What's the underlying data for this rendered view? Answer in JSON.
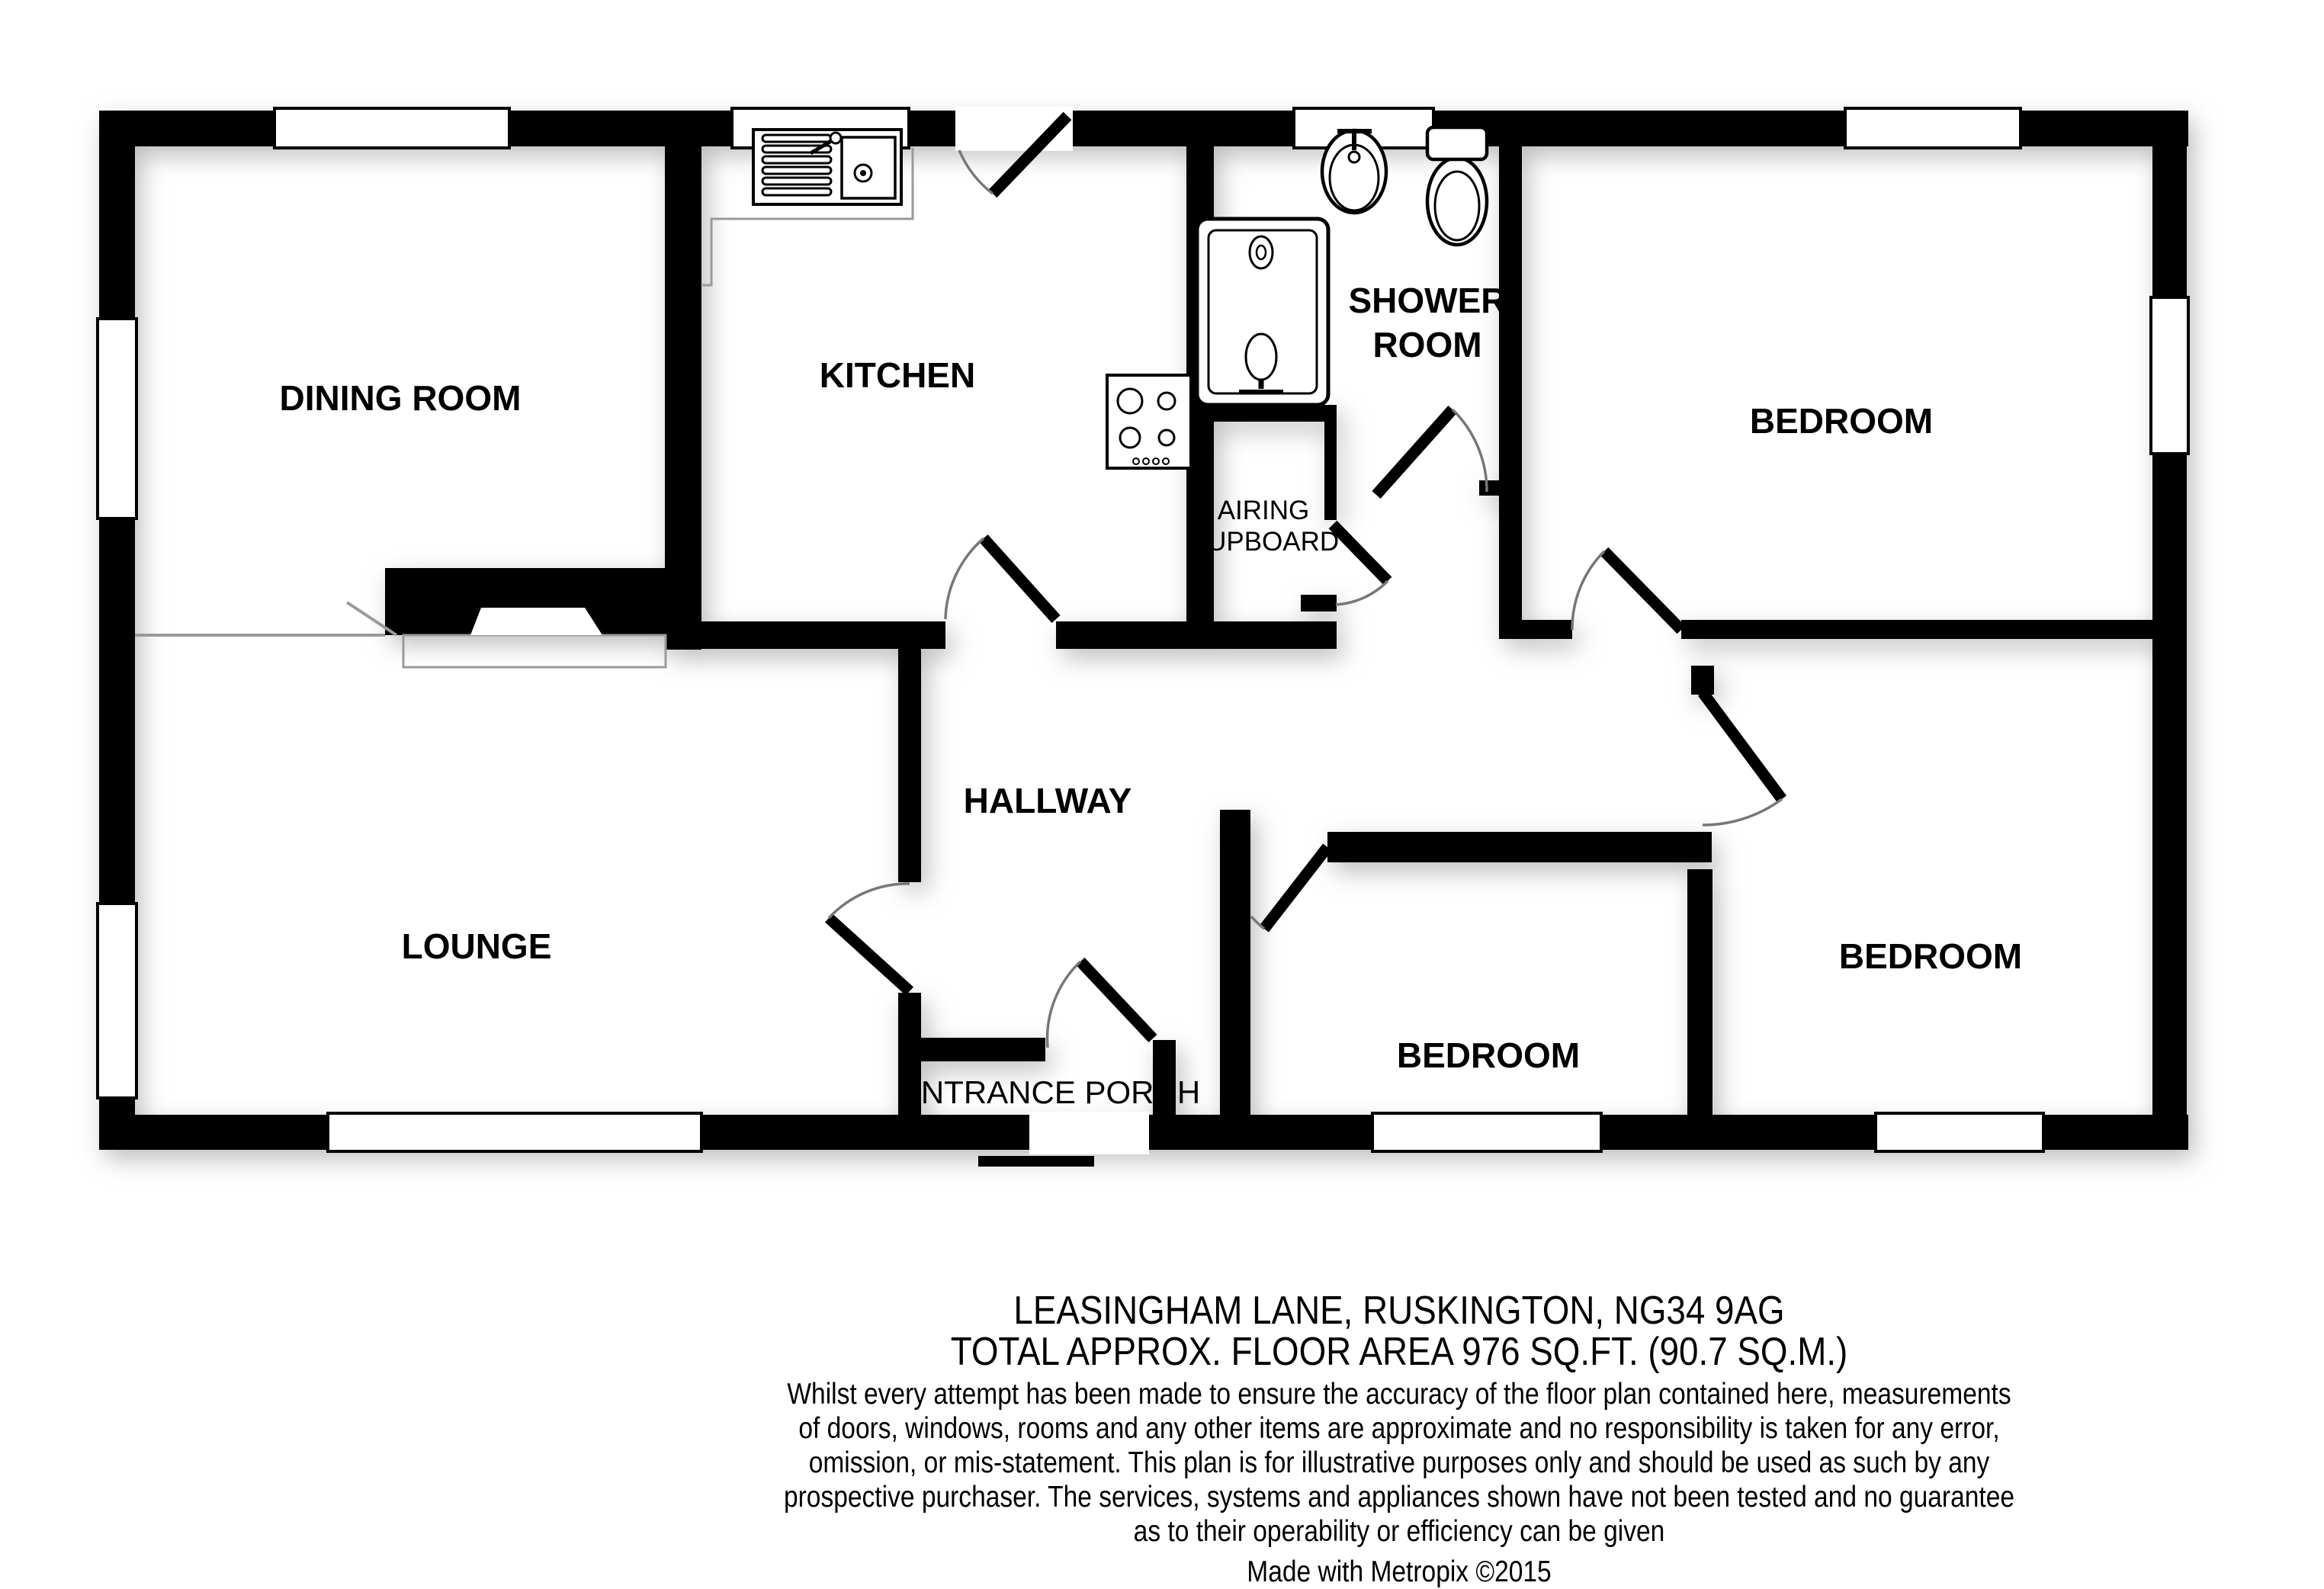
{
  "plan": {
    "rooms": {
      "dining_room": {
        "label": "DINING ROOM"
      },
      "kitchen": {
        "label": "KITCHEN"
      },
      "shower_room": {
        "label_line1": "SHOWER",
        "label_line2": "ROOM"
      },
      "airing_cupboard": {
        "label_line1": "AIRING",
        "label_line2": "CUPBOARD"
      },
      "bedroom_top_right": {
        "label": "BEDROOM"
      },
      "hallway": {
        "label": "HALLWAY"
      },
      "lounge": {
        "label": "LOUNGE"
      },
      "bedroom_middle": {
        "label": "BEDROOM"
      },
      "bedroom_bottom_right": {
        "label": "BEDROOM"
      },
      "entrance_porch": {
        "label": "ENTRANCE PORCH"
      }
    },
    "fixture_icons": [
      "kitchen-sink-icon",
      "hob-icon",
      "shower-cubicle-icon",
      "wash-basin-icon",
      "toilet-icon",
      "fireplace-icon",
      "door-swing-icon",
      "window-icon"
    ]
  },
  "footer": {
    "address_line": "LEASINGHAM LANE, RUSKINGTON, NG34 9AG",
    "area_line": "TOTAL APPROX. FLOOR AREA 976 SQ.FT. (90.7 SQ.M.)",
    "disclaimer_lines": [
      "Whilst every attempt has been made to ensure the accuracy of the floor plan contained here, measurements",
      "of doors, windows, rooms and any other items are approximate and no responsibility is taken for any error,",
      "omission, or mis-statement. This plan is for illustrative purposes only and should be used as such by any",
      "prospective purchaser. The services, systems and appliances shown have not been tested and no guarantee",
      "as to their operability or efficiency can be given"
    ],
    "credit_line": "Made with Metropix ©2015"
  },
  "colors": {
    "wall": "#000000",
    "background": "#ffffff",
    "floor": "#ffffff",
    "door_arc": "#777777",
    "divider_line": "#8a8a8a",
    "shadow": "#9a9a9a"
  }
}
